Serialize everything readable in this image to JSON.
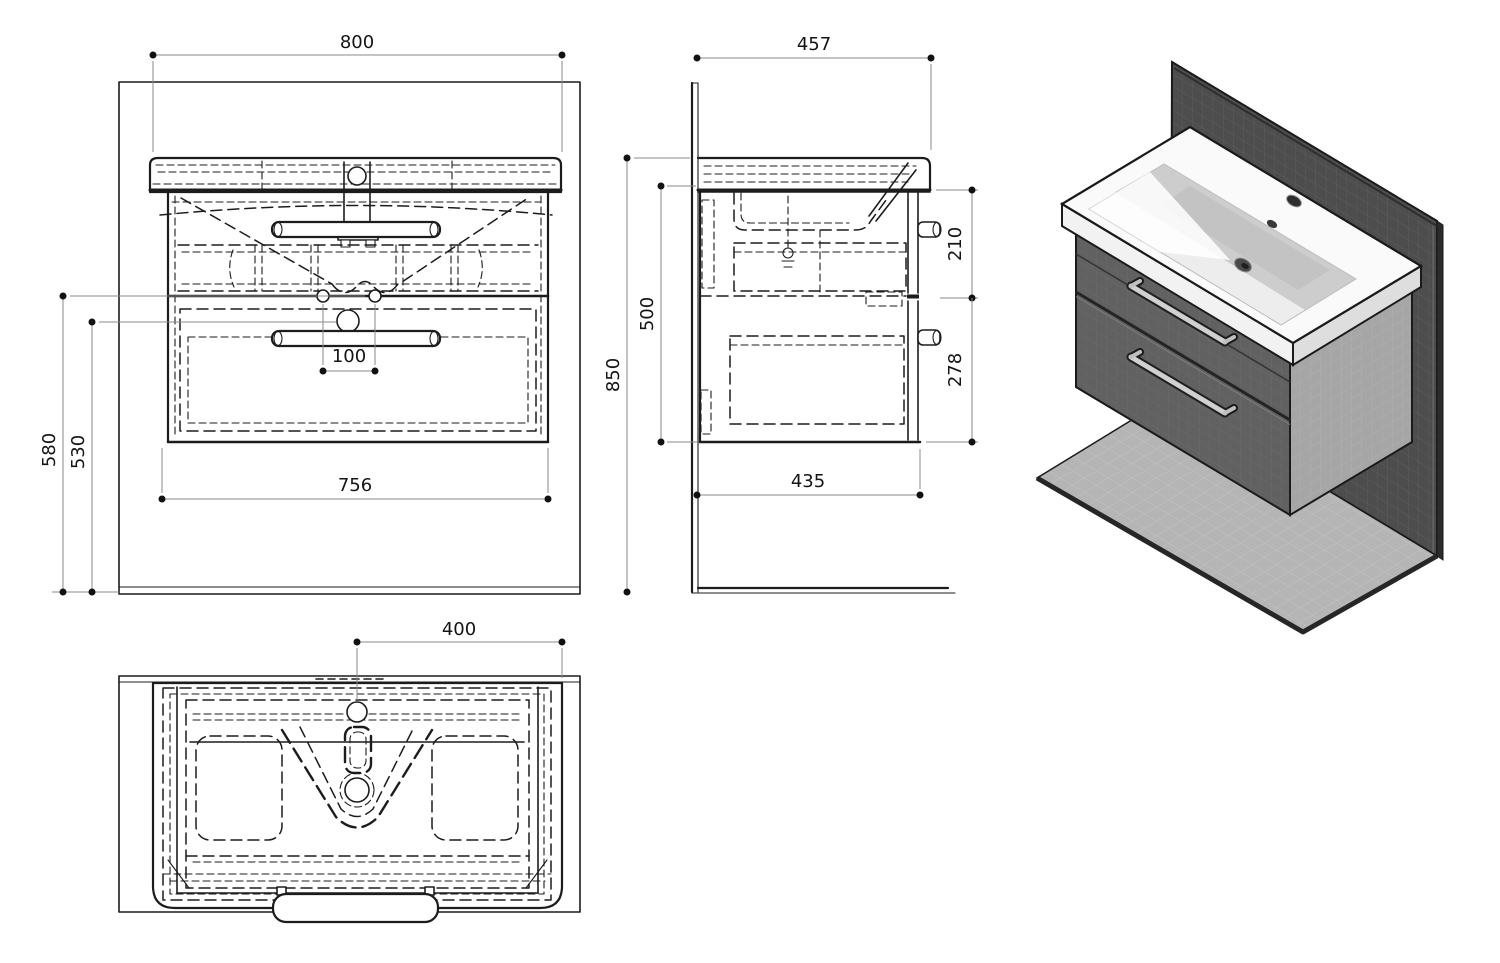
{
  "dimensions": {
    "front": {
      "sink_width": "800",
      "cabinet_width": "756",
      "height_to_mounting_holes": "580",
      "height_to_drain": "530",
      "mounting_hole_spacing": "100"
    },
    "side": {
      "basin_depth": "457",
      "overall_height": "850",
      "cabinet_height": "500",
      "top_drawer_front": "210",
      "bottom_drawer_front": "278",
      "cabinet_depth": "435"
    },
    "top": {
      "faucet_center_to_edge": "400"
    }
  },
  "colors": {
    "line": "#1c1c1c",
    "dim_line": "#8a8a8a",
    "text": "#141414",
    "wall_tile": "#4d4d4d",
    "floor": "#b5b5b5",
    "cabinet_front": "#606060",
    "cabinet_side": "#a6a6a6",
    "basin_white": "#fafafa",
    "handle_metal": "#d0d0d0"
  }
}
